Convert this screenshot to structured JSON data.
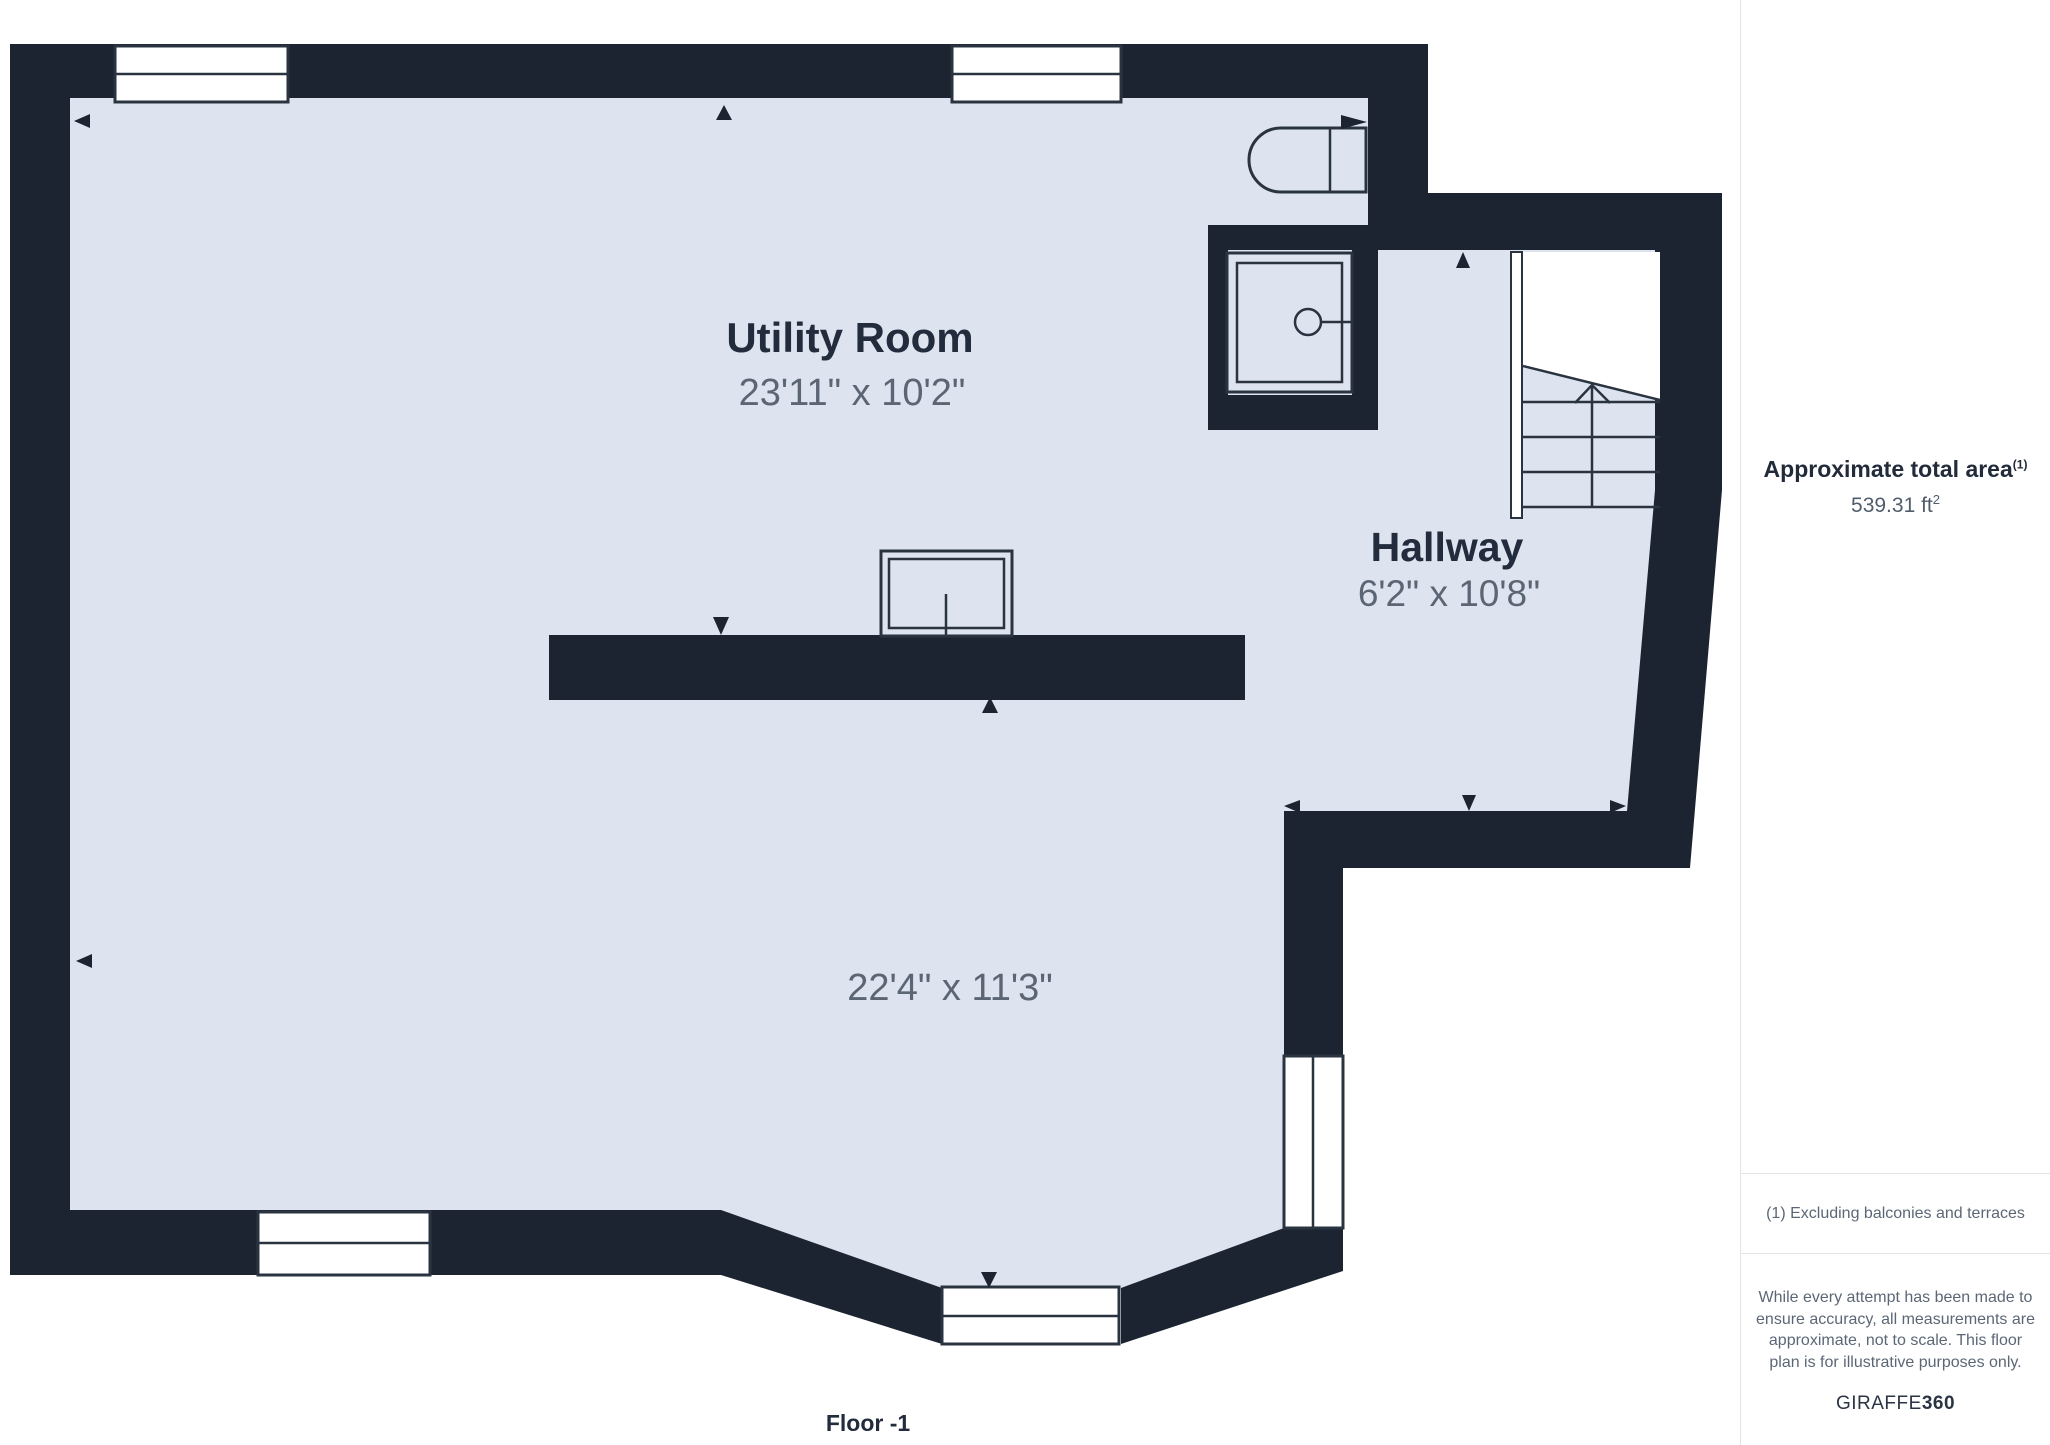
{
  "colors": {
    "wall": "#1d2431",
    "floor": "#dde3ef",
    "outline": "#2a3441",
    "room_title": "#222c3c",
    "dims_text": "#5b6574",
    "sidebar_border": "#e3e4e6",
    "muted_text": "#5c6776",
    "heading_text": "#212b3a",
    "value_text": "#515d6c",
    "brand_text": "#2b3443"
  },
  "plan": {
    "rooms": [
      {
        "name": "Utility Room",
        "dims": "23'11\" x 10'2\""
      },
      {
        "name": "Hallway",
        "dims": "6'2\" x 10'8\""
      },
      {
        "name": "",
        "dims": "22'4\" x 11'3\""
      }
    ],
    "floor_label": "Floor -1"
  },
  "sidebar": {
    "area_title": "Approximate total area",
    "area_title_sup": "(1)",
    "area_value": "539.31 ft",
    "area_value_sup": "2",
    "footnote": "(1) Excluding balconies and terraces",
    "disclaimer_lines": [
      "While every attempt has been made to",
      "ensure accuracy, all measurements are",
      "approximate, not to scale. This floor",
      "plan is for illustrative purposes only."
    ],
    "brand_name": "GIRAFFE",
    "brand_suffix": "360"
  }
}
